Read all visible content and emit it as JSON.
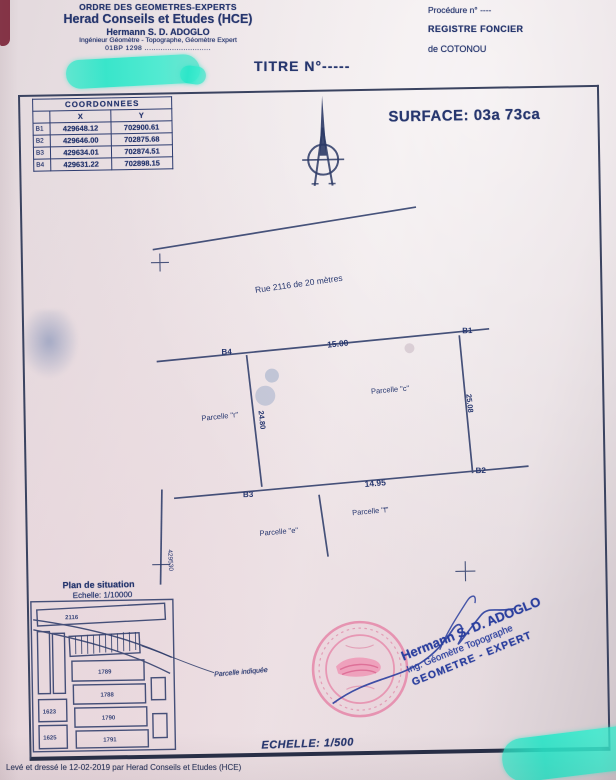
{
  "colors": {
    "ink": "#26366e",
    "highlight_teal": "#2ce9c9",
    "stamp_pink": "#e687a9",
    "signature_blue": "#2b3f9e",
    "paper": "#ebe2e5"
  },
  "header": {
    "org_line1": "ORDRE DES GEOMETRES-EXPERTS",
    "org_line2": "Herad Conseils et Etudes (HCE)",
    "org_line3": "Hermann S. D. ADOGLO",
    "org_line4": "Ingénieur Géomètre - Topographe, Géomètre Expert",
    "org_line5": "01BP 1298 .............................",
    "title": "TITRE N°-----",
    "procedure": "Procédure n° ----",
    "registre_line1": "REGISTRE FONCIER",
    "registre_line2": "de COTONOU"
  },
  "surface_label": "SURFACE: 03a 73ca",
  "coords_table": {
    "title": "COORDONNEES",
    "col_x": "X",
    "col_y": "Y",
    "rows": [
      {
        "id": "B1",
        "x": "429648.12",
        "y": "702900.61"
      },
      {
        "id": "B2",
        "x": "429646.00",
        "y": "702875.68"
      },
      {
        "id": "B3",
        "x": "429634.01",
        "y": "702874.51"
      },
      {
        "id": "B4",
        "x": "429631.22",
        "y": "702898.15"
      }
    ]
  },
  "plan": {
    "road_label": "Rue 2116 de 20 mètres",
    "corner_tl": "B4",
    "corner_tr": "B1",
    "corner_bl": "B3",
    "corner_br": "B2",
    "dim_top": "15.00",
    "dim_bottom": "14.95",
    "dim_left": "24.80",
    "dim_right": "25.08",
    "parcel_left": "Parcelle \"r\"",
    "parcel_right": "Parcelle \"c\"",
    "parcel_bottom_left": "Parcelle \"e\"",
    "parcel_bottom_right": "Parcelle \"f\"",
    "grid_label": "429530"
  },
  "situation": {
    "title": "Plan de situation",
    "scale": "Echelle: 1/10000",
    "note": "Parcelle indiquée",
    "blocks": [
      "2116",
      "1789",
      "1788",
      "1790",
      "1791",
      "1623",
      "1625"
    ]
  },
  "signature": {
    "line1": "Hermann S. D. ADOGLO",
    "line2": "Ing. Géomètre Topographe",
    "line3": "GEOMETRE - EXPERT"
  },
  "scale_main": "ECHELLE: 1/500",
  "footer": "Levé et dressé le 12-02-2019 par Herad Conseils et Etudes (HCE)"
}
